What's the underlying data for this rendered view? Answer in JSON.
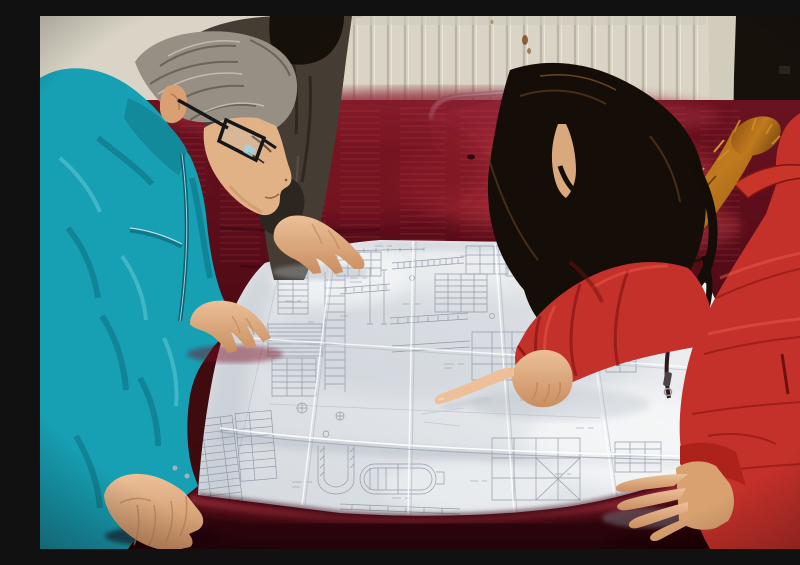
{
  "scene": {
    "type": "photograph",
    "description": "Three people lean over a large folded engineering blueprint spread on a table draped in dark red velvet; a woman in a red fur-trimmed parka points at a detail while a gray-haired man in a teal work jacket and a colleague in a dark jacket study the drawing.",
    "setting": "Indoor room with a cream radiator wall, a dark door panel at right and a metal-framed chair behind the table",
    "people": [
      {
        "id": "man",
        "hair": "gray",
        "accessories": "black rectangular glasses",
        "clothing": "teal work jacket",
        "pose": "leaning over the table, right hand on the sheet, left hand holding the paper corner"
      },
      {
        "id": "colleague",
        "hair": "black",
        "clothing": "dark brown jacket",
        "pose": "partially visible behind the man, one hand resting on the top edge of the blueprint"
      },
      {
        "id": "woman",
        "hair": "long dark wavy",
        "clothing": "red hooded parka with orange fur trim and zipper",
        "pose": "pointing at the blueprint with right index finger, left hand resting on the sheet"
      }
    ],
    "objects": [
      {
        "id": "blueprint",
        "description": "large white engineering drawing sheet with fold creases, detail tables, stair sections, beam elevations, a title block and a tank detail"
      },
      {
        "id": "table",
        "description": "table covered with dark crimson velvet cloth"
      },
      {
        "id": "chair",
        "description": "metal tube framed chair with red seat behind the table"
      },
      {
        "id": "radiator",
        "description": "cream wall radiator with vertical fins"
      },
      {
        "id": "door",
        "description": "dark door panel with pale frame strip"
      }
    ]
  },
  "colors": {
    "wall": "#d9d4c5",
    "wall_line": "#b9b3a1",
    "door": "#17110c",
    "door_frame": "#d2ccbd",
    "table_velvet": "#5d0f1b",
    "table_sheen": "#a22b34",
    "chair_metal": "#b5b9bc",
    "chair_seat": "#9c2732",
    "paper": "#e9ebee",
    "ink": "#87909f",
    "jacket_teal": "#17a0b4",
    "teal_dark": "#0c6a7c",
    "coat_red": "#c4302a",
    "coat_shadow": "#7c130f",
    "fur": "#b06a1e",
    "fur_light": "#e0a040",
    "hair_woman": "#150e08",
    "hair_man": "#978f83",
    "jacket_dark": "#453c34",
    "skin": "#e2b287",
    "skin_shadow": "#b9835a"
  }
}
